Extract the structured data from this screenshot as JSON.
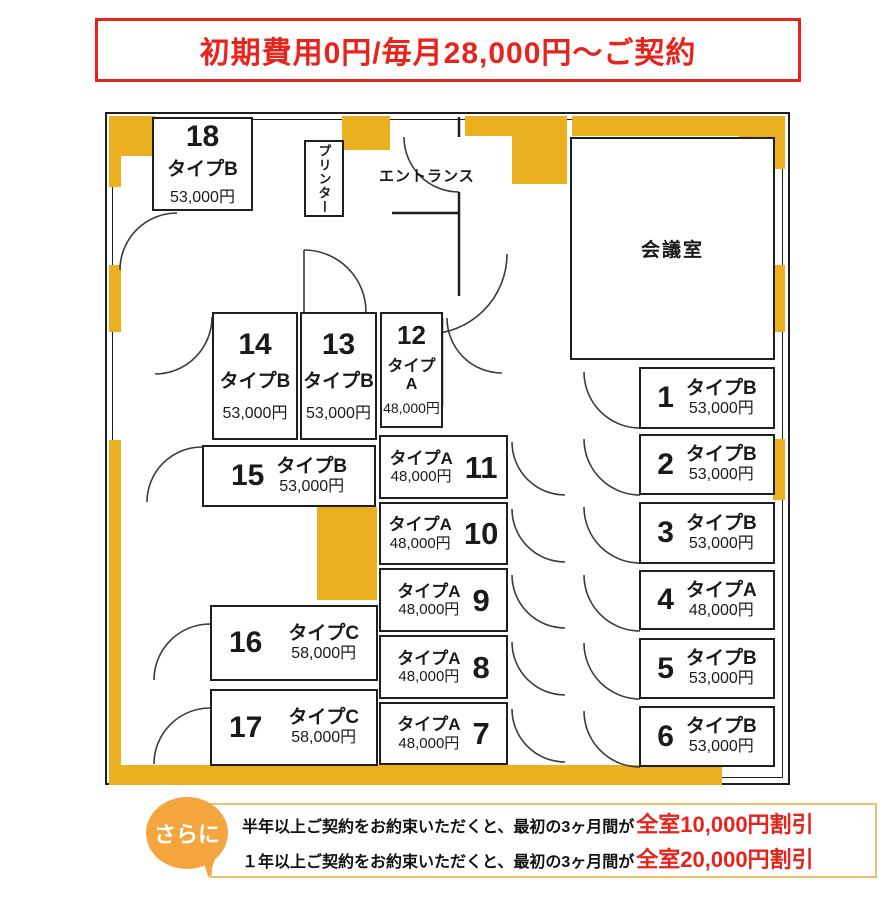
{
  "header": {
    "banner": "初期費用0円/毎月28,000円〜ご契約"
  },
  "floorplan": {
    "labels": {
      "entrance": "エントランス",
      "printer": "プリンター",
      "meeting_room": "会議室"
    },
    "rooms": [
      {
        "number": "18",
        "type": "タイプB",
        "price": "53,000円"
      },
      {
        "number": "14",
        "type": "タイプB",
        "price": "53,000円"
      },
      {
        "number": "13",
        "type": "タイプB",
        "price": "53,000円"
      },
      {
        "number": "12",
        "type": "タイプA",
        "price": "48,000円"
      },
      {
        "number": "15",
        "type": "タイプB",
        "price": "53,000円"
      },
      {
        "number": "16",
        "type": "タイプC",
        "price": "58,000円"
      },
      {
        "number": "17",
        "type": "タイプC",
        "price": "58,000円"
      },
      {
        "number": "11",
        "type": "タイプA",
        "price": "48,000円"
      },
      {
        "number": "10",
        "type": "タイプA",
        "price": "48,000円"
      },
      {
        "number": "9",
        "type": "タイプA",
        "price": "48,000円"
      },
      {
        "number": "8",
        "type": "タイプA",
        "price": "48,000円"
      },
      {
        "number": "7",
        "type": "タイプA",
        "price": "48,000円"
      },
      {
        "number": "1",
        "type": "タイプB",
        "price": "53,000円"
      },
      {
        "number": "2",
        "type": "タイプB",
        "price": "53,000円"
      },
      {
        "number": "3",
        "type": "タイプB",
        "price": "53,000円"
      },
      {
        "number": "4",
        "type": "タイプA",
        "price": "48,000円"
      },
      {
        "number": "5",
        "type": "タイプB",
        "price": "53,000円"
      },
      {
        "number": "6",
        "type": "タイプB",
        "price": "53,000円"
      }
    ]
  },
  "promo": {
    "badge": "さらに",
    "lines": [
      {
        "text": "半年以上ご契約をお約束いただくと、最初の3ヶ月間が",
        "highlight": "全室10,000円割引"
      },
      {
        "text": "１年以上ご契約をお約束いただくと、最初の3ヶ月間が",
        "highlight": "全室20,000円割引"
      }
    ]
  },
  "colors": {
    "accent_red": "#e8231c",
    "wall_yellow": "#eab01f",
    "badge_orange": "#f5a53e"
  }
}
